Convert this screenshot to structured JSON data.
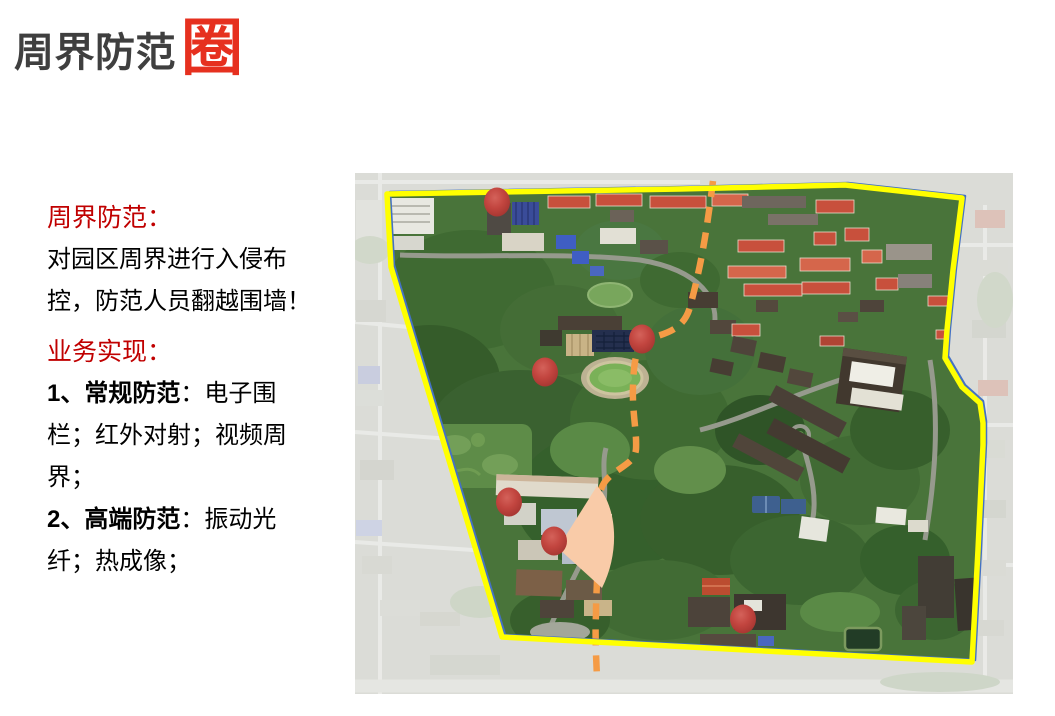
{
  "title": {
    "text": "周界防范",
    "badge": "圈"
  },
  "colors": {
    "title_gray": "#3F3F3F",
    "badge_red": "#E6301F",
    "heading_red": "#C00000",
    "body_black": "#000000",
    "boundary_yellow": "#FFFF00",
    "boundary_blue": "#4472C4",
    "route_orange": "#F59B45",
    "fan_peach": "#F9CBA8",
    "marker_red": "#C0423D"
  },
  "panel": {
    "section1": {
      "heading": "周界防范：",
      "lines": [
        "对园区周界进行入侵布",
        "控，防范人员翻越围墙！"
      ]
    },
    "section2": {
      "heading": "业务实现：",
      "item1": {
        "bold": "1、常规防范",
        "tail": "：电子围",
        "line2": "栏；红外对射；视频周",
        "line3": "界；"
      },
      "item2": {
        "bold": "2、高端防范",
        "tail": "：振动光",
        "line2": "纤；热成像；"
      }
    }
  },
  "map": {
    "boundary_points": "387,194 680,189 845,185 962,198 953,270 947,330 945,358 962,387 980,403 983,423 983,445 978,550 972,662 502,637 391,267",
    "route_path": "M713,181 C707,228 702,262 690,307 C684,329 667,333 651,338 C637,343 634,357 633,386 C632,412 637,432 636,449 C635,465 614,468 604,483 C597,494 596,515 597,553 C598,577 596,592 596,614 C595,634 596,656 597,677",
    "fan_path": "M558,548 L597,486 C615,503 622,548 602,588 Z",
    "marker_rx": 13,
    "marker_ry": 14.5,
    "markers": [
      {
        "x": 497,
        "y": 202
      },
      {
        "x": 642,
        "y": 339
      },
      {
        "x": 545,
        "y": 372
      },
      {
        "x": 509,
        "y": 502
      },
      {
        "x": 554,
        "y": 541
      },
      {
        "x": 743,
        "y": 619
      }
    ]
  }
}
